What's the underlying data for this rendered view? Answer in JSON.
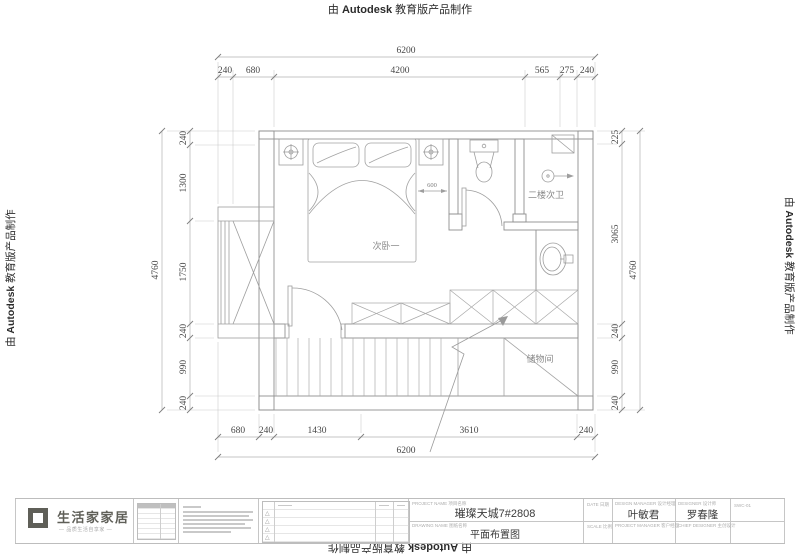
{
  "stamp": {
    "prefix": "由 ",
    "brand": "Autodesk",
    "suffix": " 教育版产品制作"
  },
  "plan_labels": {
    "bedroom": "次卧一",
    "bathroom": "二楼次卫",
    "storage": "储物间",
    "bed_offset": "600"
  },
  "dims": {
    "top": {
      "overall": "6200",
      "segments": [
        "240",
        "680",
        "4200",
        "565",
        "275",
        "240"
      ]
    },
    "bottom": {
      "overall": "6200",
      "segments": [
        "680",
        "240",
        "1430",
        "3610",
        "240"
      ]
    },
    "left": {
      "overall": "4760",
      "segments": [
        "240",
        "1300",
        "1750",
        "240",
        "990",
        "240"
      ]
    },
    "right": {
      "overall": "4760",
      "segments": [
        "225",
        "3065",
        "240",
        "990",
        "240"
      ]
    }
  },
  "title_block": {
    "logo_name": "生活家家居",
    "logo_tagline": "— 品质生活自享家 —",
    "project_label": "PROJECT NAME 项目名称",
    "project_name": "璀璨天城7#2808",
    "drawing_label": "DRAWING NAME 图纸名称",
    "drawing_name": "平面布置图",
    "date_label": "DATE 日期",
    "scale_label": "SCALE 比例",
    "design_manager_label": "DESIGN MANAGER 设计经理",
    "design_manager": "叶敏君",
    "designer_label": "DESIGNER 设计师",
    "designer": "罗春隆",
    "project_manager_label": "PROJECT MANAGER 客户经理",
    "chief_designer_label": "CHIEF DESIGNER 主创设计",
    "dwg_no": "SWC-01"
  }
}
